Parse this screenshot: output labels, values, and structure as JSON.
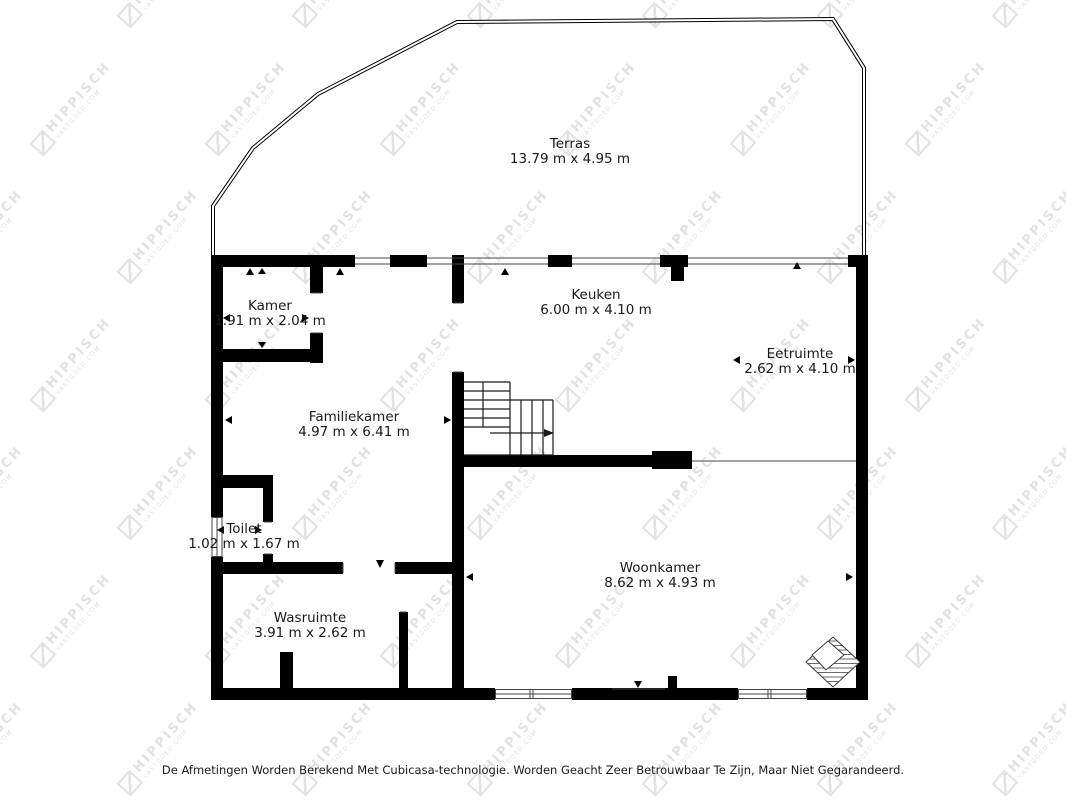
{
  "watermark": {
    "text": "HIPPISCH",
    "subtext": "VASTGOED.COM"
  },
  "disclaimer": "De Afmetingen Worden Berekend Met Cubicasa-technologie. Worden Geacht Zeer Betrouwbaar Te Zijn, Maar Niet Gegarandeerd.",
  "rooms": [
    {
      "id": "terras",
      "name": "Terras",
      "dimensions": "13.79 m x 4.95 m"
    },
    {
      "id": "kamer",
      "name": "Kamer",
      "dimensions": "1.91 m x 2.04 m"
    },
    {
      "id": "keuken",
      "name": "Keuken",
      "dimensions": "6.00 m x 4.10 m"
    },
    {
      "id": "eetruimte",
      "name": "Eetruimte",
      "dimensions": "2.62 m x 4.10 m"
    },
    {
      "id": "familiekamer",
      "name": "Familiekamer",
      "dimensions": "4.97 m x 6.41 m"
    },
    {
      "id": "toilet",
      "name": "Toilet",
      "dimensions": "1.02 m x 1.67 m"
    },
    {
      "id": "woonkamer",
      "name": "Woonkamer",
      "dimensions": "8.62 m x 4.93 m"
    },
    {
      "id": "wasruimte",
      "name": "Wasruimte",
      "dimensions": "3.91 m x 2.62 m"
    }
  ],
  "colors": {
    "wall": "#000000",
    "thin_line": "#444444",
    "background": "#ffffff",
    "watermark": "#e2e2e2",
    "text": "#1a1a1a"
  }
}
